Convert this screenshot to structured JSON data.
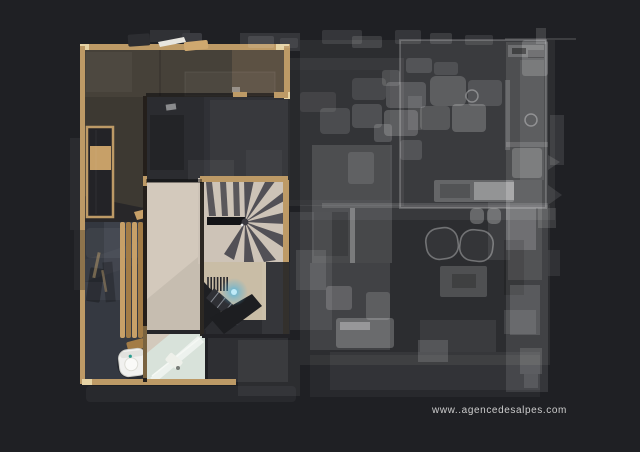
{
  "watermark": {
    "text": "www..agencedesalpes.com"
  },
  "colors": {
    "bg": "#1f2024",
    "wall-wood": "#bd9a66",
    "wall-wood-light": "#e6d3a4",
    "floor-terrace": "#464139",
    "floor-dark-room": "#303136",
    "floor-slate": "#3d414a",
    "floor-wood-light": "#d3c9bc",
    "floor-landing": "#c9bda6",
    "stair-tread": "#45444b",
    "stair-room-dark": "#2b2c30",
    "bench-wood": "#c7a068",
    "bench-wood-dark": "#a37c46",
    "shower-floor": "#d8e2da",
    "toilet-white": "#f1f1ef",
    "scan-glow": "#54b4dc",
    "ghost-low": "rgba(255,255,255,0.06)",
    "ghost-mid": "rgba(255,255,255,0.13)",
    "ghost-high": "rgba(255,255,255,0.22)",
    "ghost-stroke": "rgba(255,255,255,0.32)",
    "watermark-color": "#d6d6d6"
  }
}
